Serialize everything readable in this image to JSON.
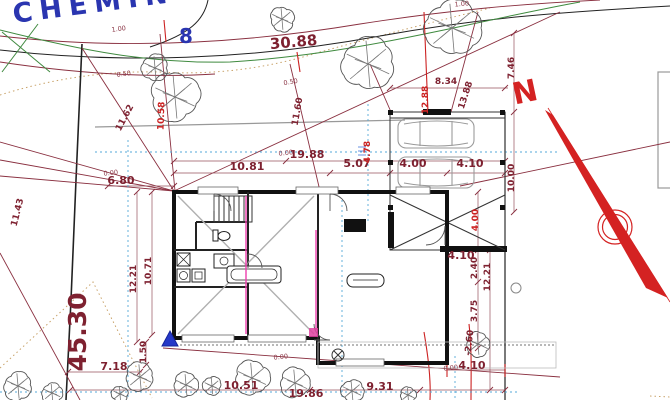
{
  "colors": {
    "maroon": "#7e2130",
    "red": "#cc2222",
    "street_blue": "#2a35b0",
    "green": "#3f8a3f",
    "cyan": "#54a8d8",
    "tan": "#c9a36a",
    "magenta": "#ee3fae",
    "gray": "#999999"
  },
  "road": {
    "street_name": "CHEMIN DU PE",
    "lot_number": "8",
    "frontage": "30.88"
  },
  "boundary": {
    "left_length": "45.30"
  },
  "north_label": "N",
  "labels": [
    {
      "text": "1.00",
      "x": 119,
      "y": 31,
      "rot": -8,
      "cls": "sm"
    },
    {
      "text": "1.00",
      "x": 462,
      "y": 6,
      "rot": -5,
      "cls": "sm"
    },
    {
      "text": "0.50",
      "x": 124,
      "y": 76,
      "rot": -8,
      "cls": "sm"
    },
    {
      "text": "0.50",
      "x": 291,
      "y": 84,
      "rot": -10,
      "cls": "sm"
    },
    {
      "text": "11.62",
      "x": 127,
      "y": 119,
      "rot": -62,
      "cls": "md"
    },
    {
      "text": "10.58",
      "x": 164,
      "y": 116,
      "rot": -88,
      "cls": "red"
    },
    {
      "text": "11.43",
      "x": 20,
      "y": 213,
      "rot": -76,
      "cls": "md"
    },
    {
      "text": "11.60",
      "x": 300,
      "y": 112,
      "rot": -80,
      "cls": "md"
    },
    {
      "text": "12.88",
      "x": 428,
      "y": 100,
      "rot": -90,
      "cls": "red"
    },
    {
      "text": "13.88",
      "x": 468,
      "y": 96,
      "rot": -72,
      "cls": "md"
    },
    {
      "text": "8.34",
      "x": 446,
      "y": 84,
      "rot": 0,
      "cls": "md"
    },
    {
      "text": "7.46",
      "x": 514,
      "y": 68,
      "rot": -90,
      "cls": "md"
    },
    {
      "text": "10.00",
      "x": 514,
      "y": 178,
      "rot": -90,
      "cls": "md"
    },
    {
      "text": "19.88",
      "x": 307,
      "y": 158,
      "rot": 0,
      "cls": "lg"
    },
    {
      "text": "0.00",
      "x": 286,
      "y": 155,
      "rot": -6,
      "cls": "sm"
    },
    {
      "text": "10.81",
      "x": 247,
      "y": 170,
      "rot": 0,
      "cls": "lg"
    },
    {
      "text": "5.07",
      "x": 357,
      "y": 167,
      "rot": 0,
      "cls": "lg"
    },
    {
      "text": "4.00",
      "x": 413,
      "y": 167,
      "rot": 0,
      "cls": "lg"
    },
    {
      "text": "4.10",
      "x": 470,
      "y": 167,
      "rot": 0,
      "cls": "lg"
    },
    {
      "text": "6.80",
      "x": 121,
      "y": 184,
      "rot": 0,
      "cls": "lg"
    },
    {
      "text": "0.00",
      "x": 111,
      "y": 175,
      "rot": -6,
      "cls": "sm"
    },
    {
      "text": "4.78",
      "x": 370,
      "y": 152,
      "rot": -90,
      "cls": "red"
    },
    {
      "text": "4.00",
      "x": 478,
      "y": 220,
      "rot": -90,
      "cls": "red"
    },
    {
      "text": "4.10",
      "x": 461,
      "y": 259,
      "rot": 0,
      "cls": "lg"
    },
    {
      "text": "2.40",
      "x": 477,
      "y": 268,
      "rot": -90,
      "cls": "md"
    },
    {
      "text": "12.21",
      "x": 490,
      "y": 277,
      "rot": -90,
      "cls": "md"
    },
    {
      "text": "3.75",
      "x": 477,
      "y": 311,
      "rot": -90,
      "cls": "md"
    },
    {
      "text": "-2.60",
      "x": 472,
      "y": 343,
      "rot": -84,
      "cls": "md"
    },
    {
      "text": "12.21",
      "x": 136,
      "y": 279,
      "rot": -90,
      "cls": "md"
    },
    {
      "text": "10.71",
      "x": 151,
      "y": 271,
      "rot": -90,
      "cls": "md"
    },
    {
      "text": "1.50",
      "x": 146,
      "y": 352,
      "rot": -90,
      "cls": "md"
    },
    {
      "text": "7.18",
      "x": 114,
      "y": 370,
      "rot": 0,
      "cls": "lg"
    },
    {
      "text": "10.51",
      "x": 241,
      "y": 389,
      "rot": 0,
      "cls": "lg"
    },
    {
      "text": "19.86",
      "x": 306,
      "y": 397,
      "rot": 0,
      "cls": "lg"
    },
    {
      "text": "9.31",
      "x": 380,
      "y": 390,
      "rot": 0,
      "cls": "lg"
    },
    {
      "text": "0.00",
      "x": 281,
      "y": 359,
      "rot": -6,
      "cls": "sm"
    },
    {
      "text": "4.10",
      "x": 472,
      "y": 369,
      "rot": 0,
      "cls": "lg"
    },
    {
      "text": "0.00",
      "x": 451,
      "y": 370,
      "rot": -6,
      "cls": "sm"
    }
  ],
  "trees": [
    {
      "x": 155,
      "y": 68,
      "r": 13
    },
    {
      "x": 175,
      "y": 97,
      "r": 24
    },
    {
      "x": 368,
      "y": 64,
      "r": 26
    },
    {
      "x": 452,
      "y": 28,
      "r": 27
    },
    {
      "x": 282,
      "y": 19,
      "r": 12
    },
    {
      "x": 18,
      "y": 386,
      "r": 14
    },
    {
      "x": 52,
      "y": 393,
      "r": 10
    },
    {
      "x": 120,
      "y": 394,
      "r": 8
    },
    {
      "x": 140,
      "y": 377,
      "r": 14
    },
    {
      "x": 186,
      "y": 385,
      "r": 12
    },
    {
      "x": 212,
      "y": 386,
      "r": 9
    },
    {
      "x": 252,
      "y": 378,
      "r": 17
    },
    {
      "x": 295,
      "y": 383,
      "r": 15
    },
    {
      "x": 352,
      "y": 391,
      "r": 11
    },
    {
      "x": 408,
      "y": 395,
      "r": 8
    },
    {
      "x": 478,
      "y": 344,
      "r": 12
    }
  ]
}
